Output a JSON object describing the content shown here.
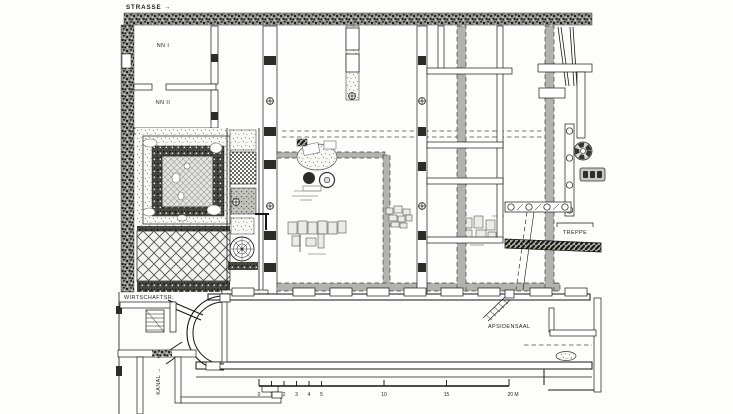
{
  "plan": {
    "title_hint": "excavation floor plan",
    "labels": {
      "strasse": "STRASSE →",
      "nn1": "NN I",
      "nn2": "NN II",
      "wirtschaftsr": "WIRTSCHAFTSR.",
      "kanal": "KANAL →",
      "treppe": "TREPPE",
      "apsidensaal": "APSIDENSAAL"
    },
    "scale_bar": {
      "unit": "M",
      "ticks": [
        0,
        1,
        2,
        3,
        4,
        5,
        10,
        15,
        20
      ],
      "tick_labels": [
        "0",
        "1",
        "2",
        "3",
        "4",
        "5",
        "10",
        "15",
        "20 M"
      ]
    },
    "colors": {
      "paper": "#fdfdfb",
      "ink": "#161614",
      "later_wall_gray": "#b2b2ae",
      "street_fill": "#8f8f8b"
    }
  }
}
